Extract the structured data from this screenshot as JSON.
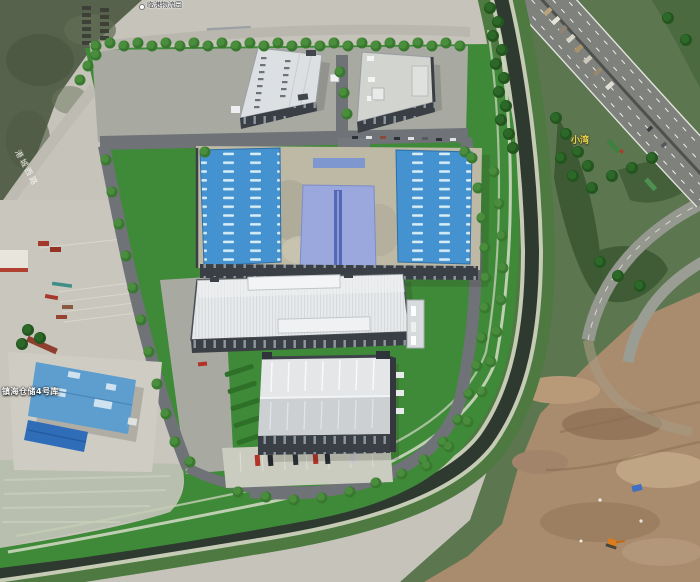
{
  "view": {
    "kind": "aerial-satellite-with-3d-render",
    "site": "industrial park master-plan rendering beside a canal and highway interchange"
  },
  "labels": {
    "place_top": "临港物流园",
    "road_left": "港城西路",
    "warehouse_sw": "镇海仓储4号库",
    "village_east": "小湾"
  },
  "palette": {
    "lawn": "#3f8a38",
    "roof_blue": "#4492cf",
    "roof_center_hall": "#9aa8de",
    "roof_light": "#e6e8ea",
    "wall_dark": "#3a3f45",
    "water": "#2e3a2f",
    "asphalt": "#6f7276",
    "concrete": "#c6c4ba",
    "dirt": "#a98c6d",
    "highway": "#7e817c",
    "tree": "#2e6d28",
    "label_yellow": "#e8d44a"
  },
  "vehicles": {
    "parking_car_colors": [
      "#b23327",
      "#23282e",
      "#2a3037",
      "#b23327",
      "#262c33",
      "#c3c7cb"
    ],
    "highway_truck_count": 8
  }
}
